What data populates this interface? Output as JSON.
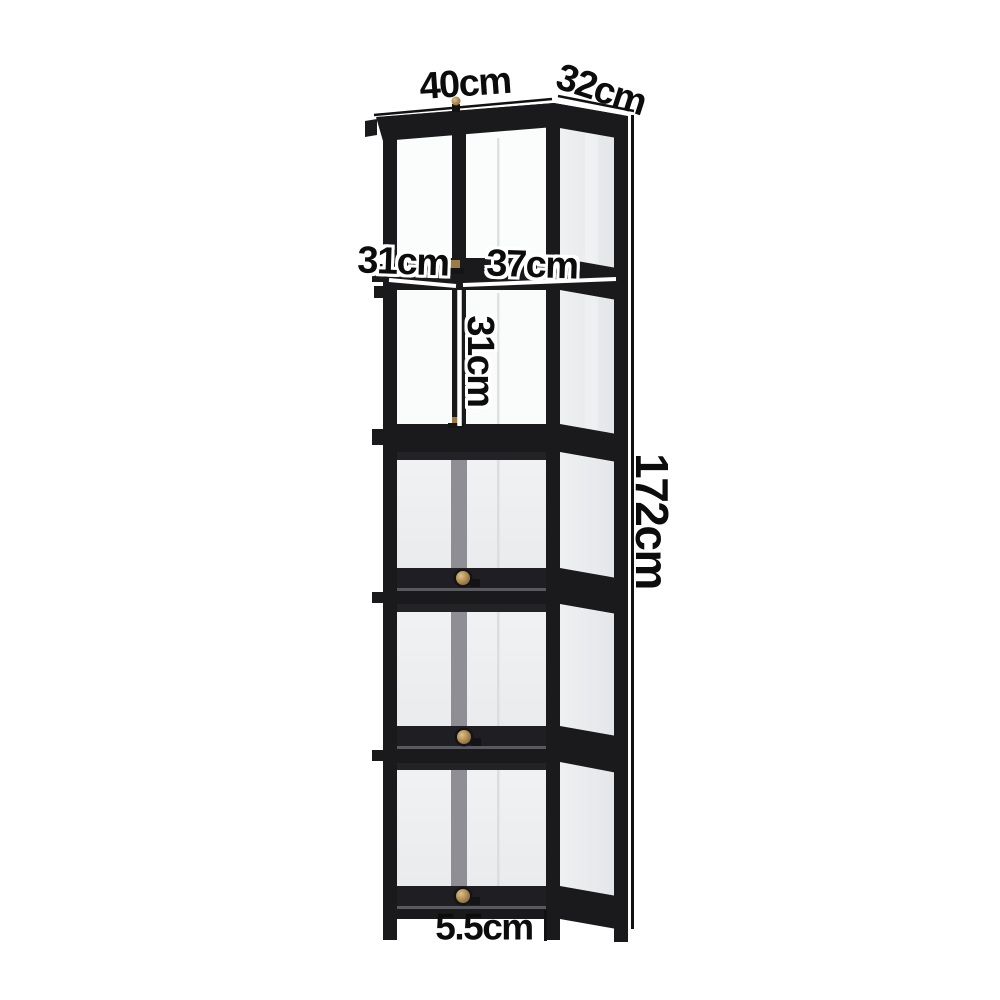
{
  "figure": {
    "type": "product-dimension-diagram",
    "subject": "black metal display cabinet with glass panels, 5 tiers, flip-up doors with brass knobs",
    "background": "#ffffff"
  },
  "dimensions": {
    "top_width": "40cm",
    "top_depth": "32cm",
    "shelf_left": "31cm",
    "shelf_right": "37cm",
    "tier_height": "31cm",
    "total_height": "172cm",
    "leg_height": "5.5cm"
  },
  "colors": {
    "frame": "#1a1a1d",
    "top_glass": "#26262b",
    "glass_front_interior": "#fbfcfc",
    "glass_door": "#eef0f1",
    "glass_side": "#e8eaec",
    "inner_divider": "#8e8e94",
    "knob_brass": "#a8854e",
    "dimension_line_dark": "#111111",
    "dimension_line_light": "#ffffff",
    "label_text": "#0c0c0c"
  }
}
